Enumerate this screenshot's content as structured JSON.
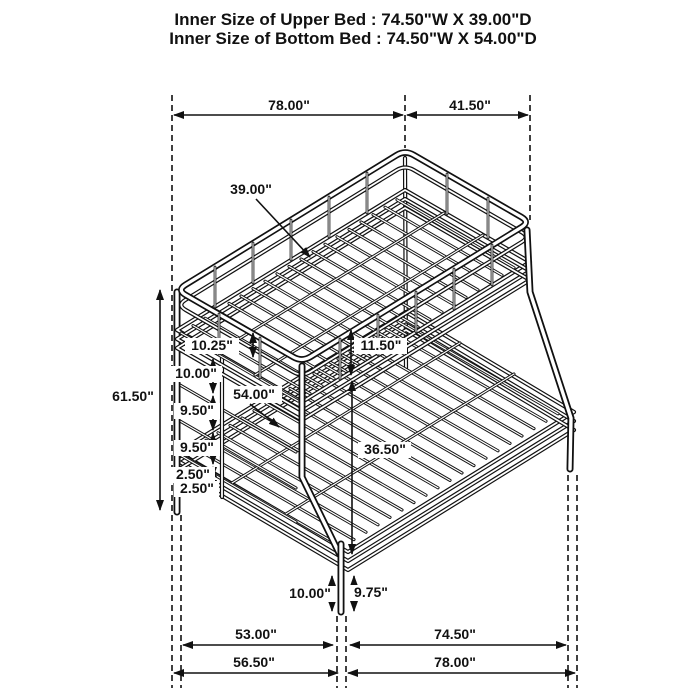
{
  "title": {
    "line1": "Inner Size of Upper Bed : 74.50\"W X 39.00\"D",
    "line2": "Inner Size of Bottom Bed : 74.50\"W X 54.00\"D"
  },
  "dimensions": {
    "top_width": "78.00\"",
    "top_depth": "41.50\"",
    "overall_height": "61.50\"",
    "upper_bed_depth": "39.00\"",
    "ladder_spacings": [
      "10.25\"",
      "10.00\"",
      "9.50\"",
      "9.50\"",
      "2.50\"",
      "2.50\""
    ],
    "upper_lower_gap": "11.50\"",
    "lower_bed_depth": "54.00\"",
    "under_bed_clearance": "36.50\"",
    "front_leg_height": "10.00\"",
    "side_leg_height": "9.75\"",
    "bottom_inner_depth": "53.00\"",
    "bottom_inner_width": "74.50\"",
    "bottom_outer_depth": "56.50\"",
    "bottom_outer_width": "78.00\""
  },
  "colors": {
    "line": "#111111",
    "background": "#ffffff"
  }
}
